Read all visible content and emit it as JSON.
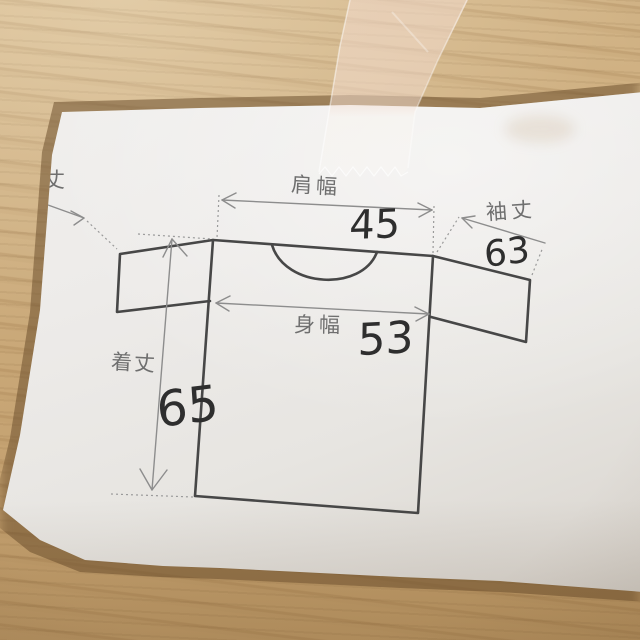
{
  "scene": {
    "description": "Photograph of a T-shirt size diagram printed on white paper, fixed to a light wooden table with translucent tape"
  },
  "diagram": {
    "garment": "t-shirt flat sketch",
    "measurements": [
      {
        "id": "shoulder-width",
        "label": "肩幅",
        "value": "45"
      },
      {
        "id": "sleeve-length",
        "label": "袖丈",
        "value": "63"
      },
      {
        "id": "body-width",
        "label": "身幅",
        "value": "53"
      },
      {
        "id": "body-length",
        "label": "着丈",
        "value": "65"
      }
    ],
    "clipped_label": "丈"
  },
  "colors": {
    "wood": "#cbaa7c",
    "paper": "#eceae7",
    "shirt_outline": "#474747",
    "dimension_lines": "#8d8d8d",
    "label_text": "#6f6f6f",
    "handwriting": "#2e2e2e",
    "tape": "#f2dbce"
  }
}
